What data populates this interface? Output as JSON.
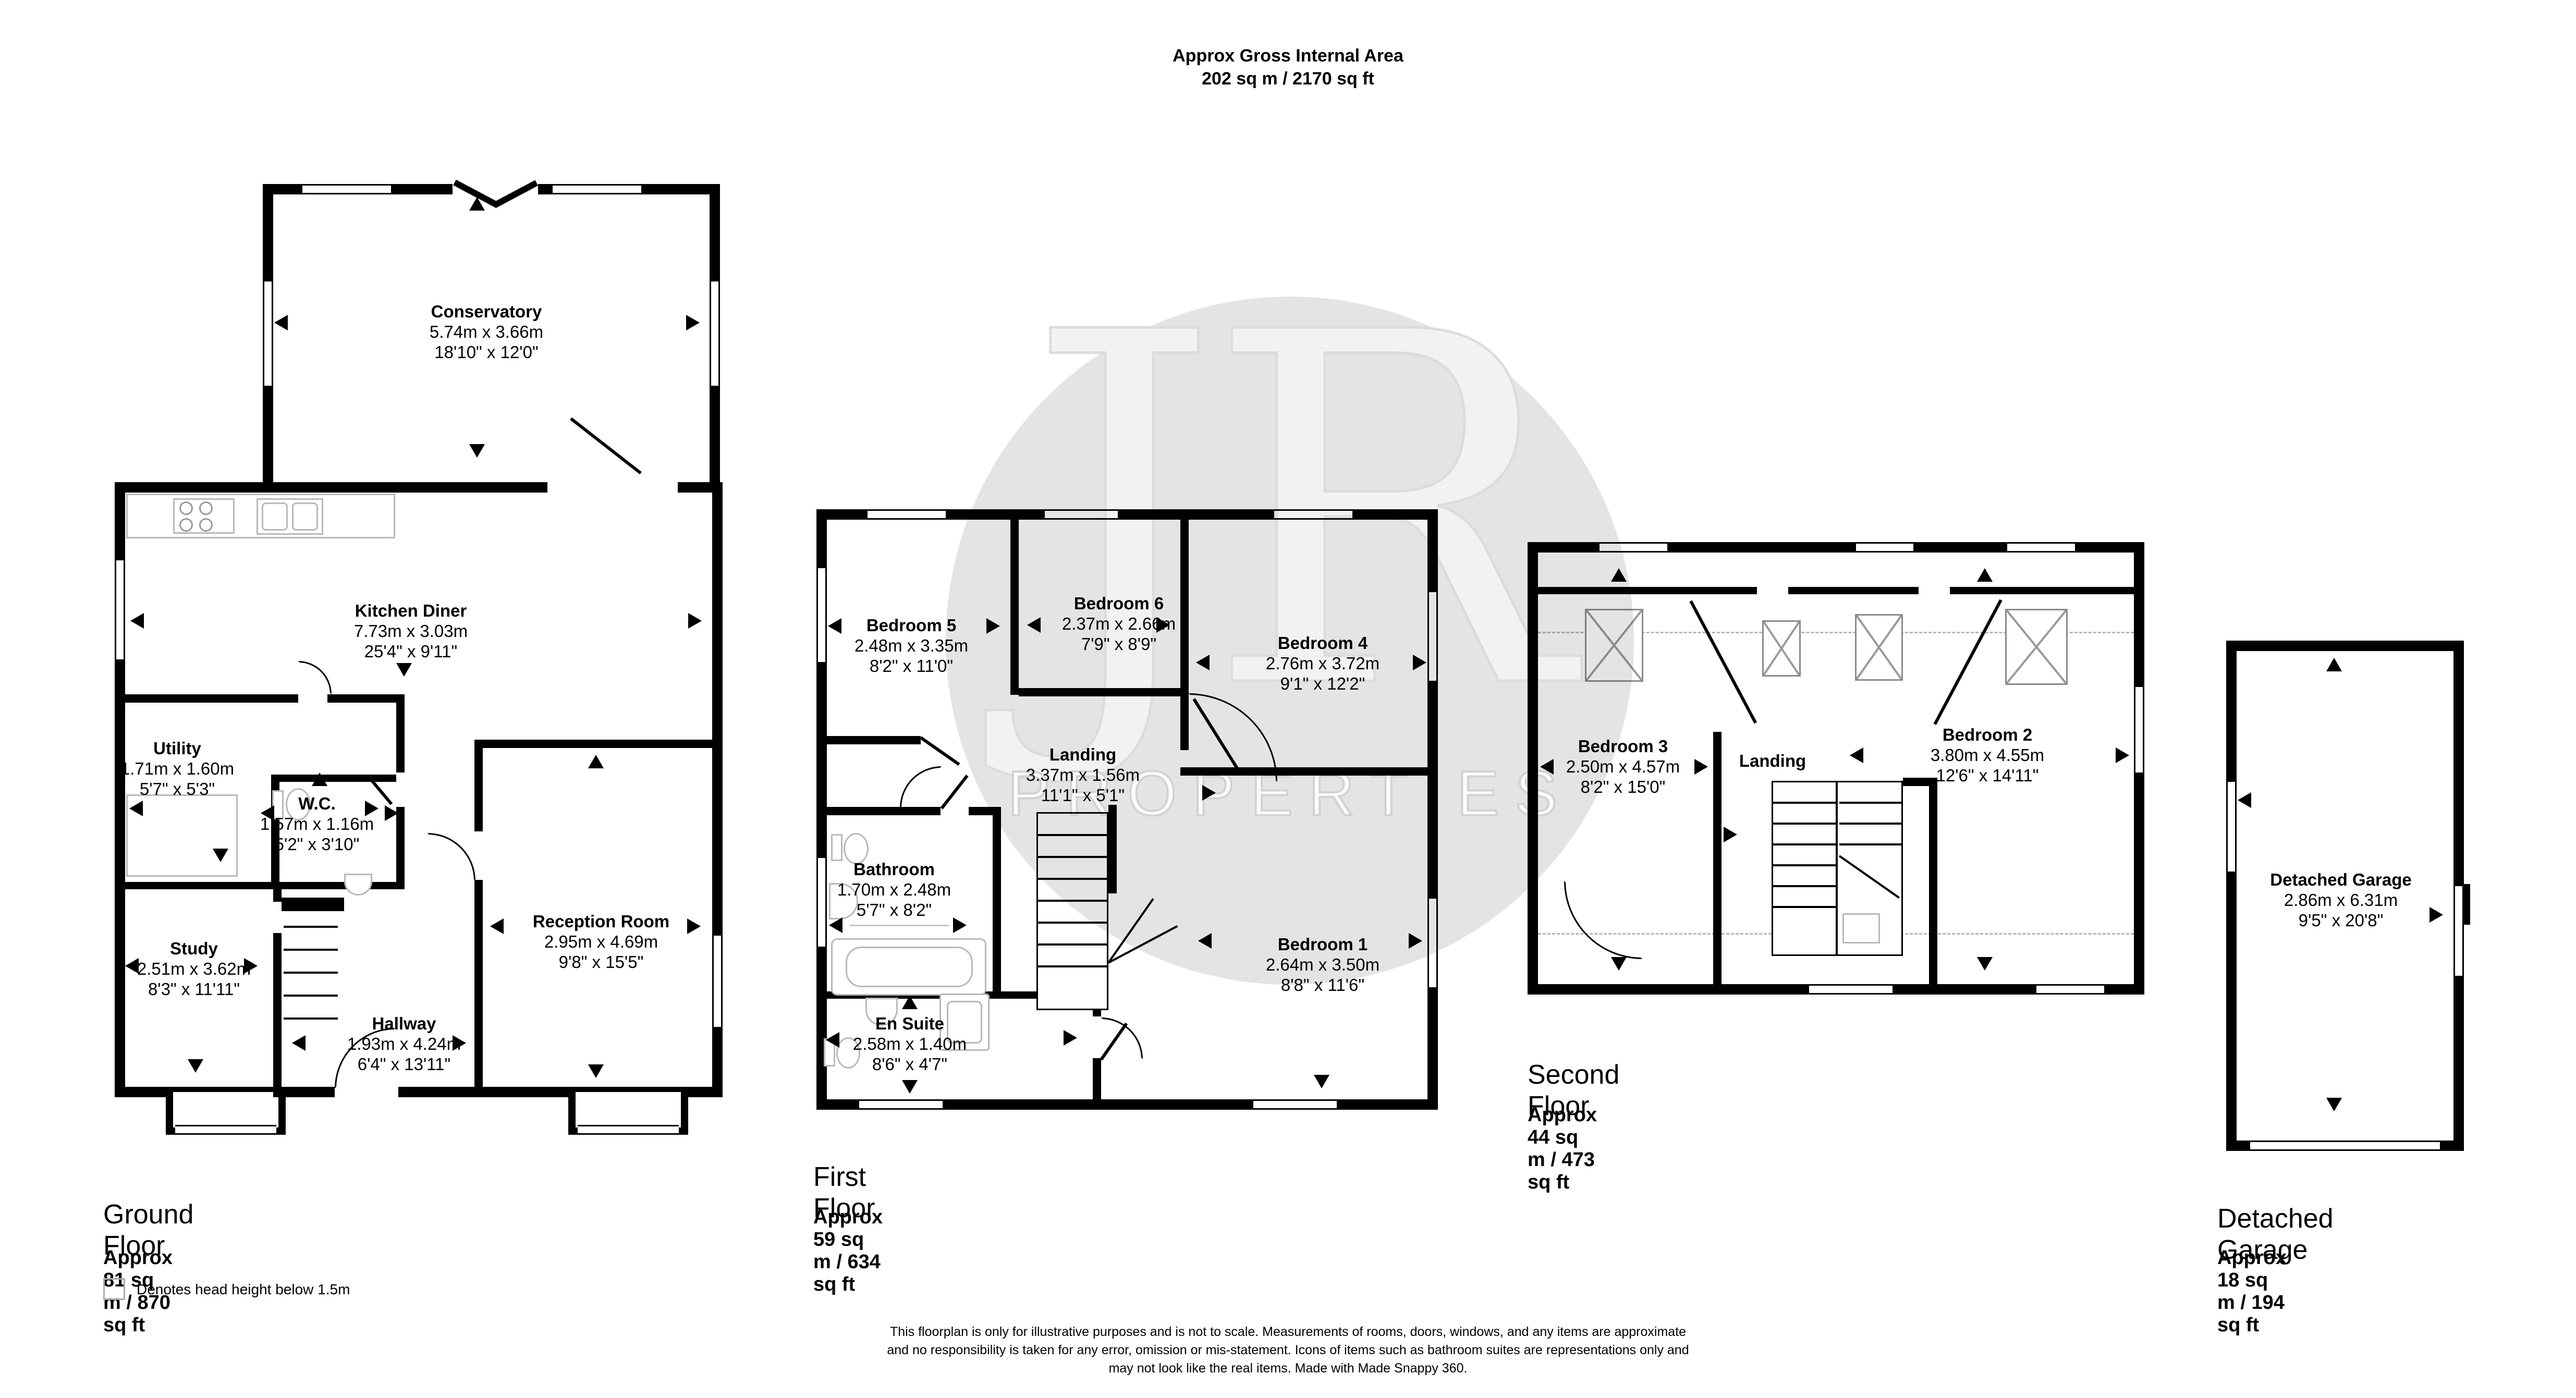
{
  "header": {
    "line1": "Approx Gross Internal Area",
    "line2": "202 sq m / 2170 sq ft"
  },
  "watermark": {
    "monogram": "JR",
    "text": "PROPERTIES"
  },
  "floors": [
    {
      "label": "Ground Floor",
      "area": "Approx 81 sq m / 870 sq ft",
      "rooms": [
        {
          "name": "Conservatory",
          "metric": "5.74m x 3.66m",
          "imperial": "18'10\" x 12'0\""
        },
        {
          "name": "Kitchen Diner",
          "metric": "7.73m x 3.03m",
          "imperial": "25'4\" x 9'11\""
        },
        {
          "name": "Utility",
          "metric": "1.71m x 1.60m",
          "imperial": "5'7\" x 5'3\""
        },
        {
          "name": "W.C.",
          "metric": "1.57m x 1.16m",
          "imperial": "5'2\" x 3'10\""
        },
        {
          "name": "Study",
          "metric": "2.51m x 3.62m",
          "imperial": "8'3\" x 11'11\""
        },
        {
          "name": "Hallway",
          "metric": "1.93m x 4.24m",
          "imperial": "6'4\" x 13'11\""
        },
        {
          "name": "Reception Room",
          "metric": "2.95m x 4.69m",
          "imperial": "9'8\" x 15'5\""
        }
      ]
    },
    {
      "label": "First Floor",
      "area": "Approx 59 sq m / 634 sq ft",
      "rooms": [
        {
          "name": "Bedroom 5",
          "metric": "2.48m x 3.35m",
          "imperial": "8'2\" x 11'0\""
        },
        {
          "name": "Bedroom 6",
          "metric": "2.37m x 2.66m",
          "imperial": "7'9\" x 8'9\""
        },
        {
          "name": "Bedroom 4",
          "metric": "2.76m x 3.72m",
          "imperial": "9'1\" x 12'2\""
        },
        {
          "name": "Landing",
          "metric": "3.37m x 1.56m",
          "imperial": "11'1\" x 5'1\""
        },
        {
          "name": "Bathroom",
          "metric": "1.70m x 2.48m",
          "imperial": "5'7\" x 8'2\""
        },
        {
          "name": "En Suite",
          "metric": "2.58m x 1.40m",
          "imperial": "8'6\" x 4'7\""
        },
        {
          "name": "Bedroom 1",
          "metric": "2.64m x 3.50m",
          "imperial": "8'8\" x 11'6\""
        }
      ]
    },
    {
      "label": "Second Floor",
      "area": "Approx 44 sq m / 473 sq ft",
      "rooms": [
        {
          "name": "Bedroom 3",
          "metric": "2.50m x 4.57m",
          "imperial": "8'2\" x 15'0\""
        },
        {
          "name": "Landing",
          "metric": "",
          "imperial": ""
        },
        {
          "name": "Bedroom 2",
          "metric": "3.80m x 4.55m",
          "imperial": "12'6\" x 14'11\""
        }
      ]
    },
    {
      "label": "Detached Garage",
      "area": "Approx 18 sq m / 194 sq ft",
      "rooms": [
        {
          "name": "Detached Garage",
          "metric": "2.86m x 6.31m",
          "imperial": "9'5\" x 20'8\""
        }
      ]
    }
  ],
  "legend": {
    "text": "Denotes head height below 1.5m"
  },
  "disclaimer": {
    "line1": "This floorplan is only for illustrative purposes and is not to scale. Measurements of rooms, doors, windows, and any items are approximate",
    "line2": "and no responsibility is taken for any error, omission or mis-statement. Icons of items such as bathroom suites are representations only and",
    "line3": "may not look like the real items. Made with Made Snappy 360."
  }
}
